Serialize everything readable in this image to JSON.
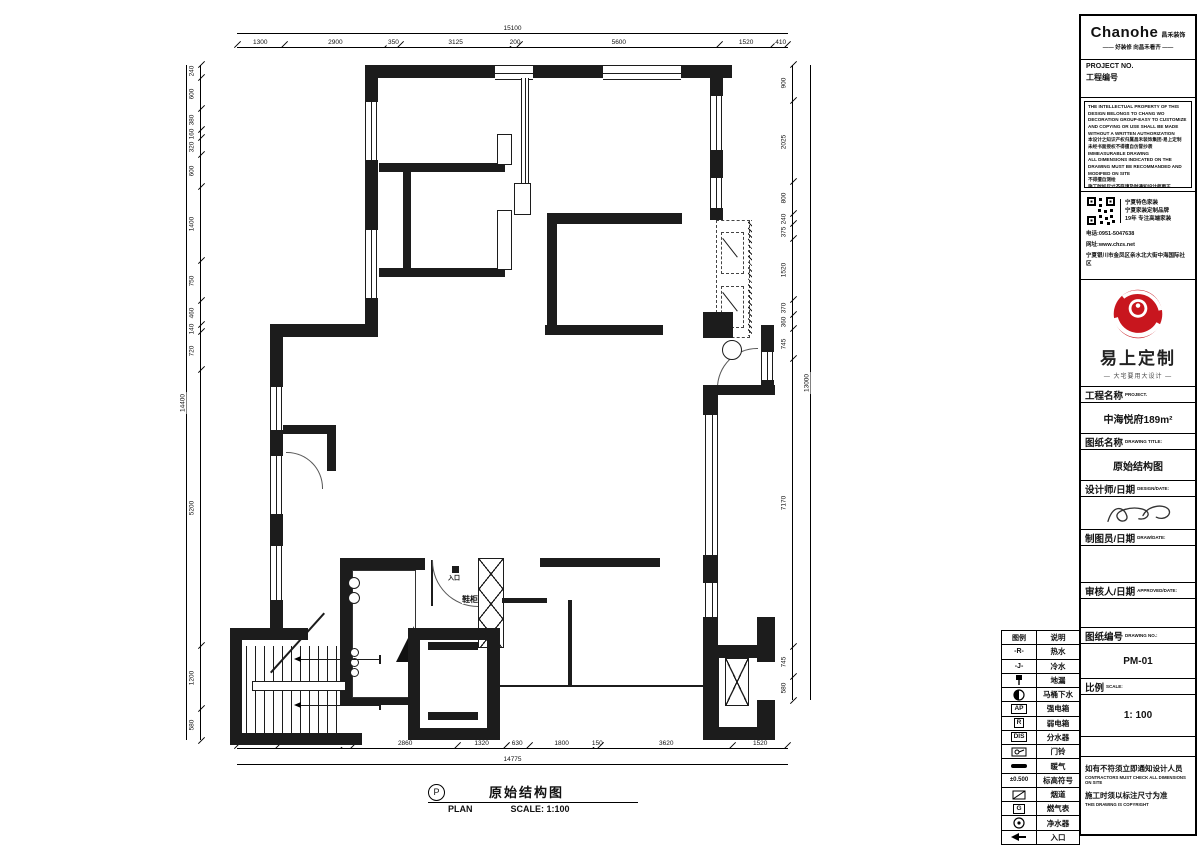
{
  "brand": {
    "logo_text": "Chanohe",
    "logo_cn": "昌禾装饰",
    "tagline": "—— 好装修 向昌禾看齐 ——"
  },
  "project_no": {
    "label_en": "PROJECT  NO.",
    "label_cn": "工程编号"
  },
  "notice_lines": [
    "THE INTELLECTUAL PROPERTY OF THIS",
    "DESIGN BELONGS TO CHANG WO",
    "DECORATION GROUP-EASY TO CUSTOMIZE",
    "AND COPYING OR USE SHALL BE MADE",
    "WITHOUT A WRITTEN AUTHORIZATION",
    "本设计之知识产权归属昌禾装饰集团-易上定制",
    "未经书面授权不得擅自仿冒抄袭",
    "IMMEASURABLE DRAWING",
    "ALL DIMENSIONS INDICATED ON THE",
    "DRAWING MUST BE RECOMMANDED AND",
    "MODIFIED ON SITE",
    "不得擅自测绘",
    "施工时如尺寸不符请及时通知设计师更正"
  ],
  "contact": {
    "qr_lines": [
      "宁夏特色家装",
      "宁夏家装定制品牌",
      "19年 专注高端家装"
    ],
    "phone": "电话:0951-5047638",
    "website": "网址:www.chzs.net",
    "address": "宁夏银川市金凤区亲水北大街中海国际社区"
  },
  "red_brand": {
    "name": "易上定制",
    "tagline": "— 大宅要用大设计 —"
  },
  "fields": {
    "project_name": {
      "label_cn": "工程名称",
      "label_en": "PROJECT.",
      "value": "中海悦府189m²"
    },
    "drawing_title": {
      "label_cn": "图纸名称",
      "label_en": "DRAWING TITLE:",
      "value": "原始结构图"
    },
    "designer": {
      "label_cn": "设计师/日期",
      "label_en": "DESIGN/DATE:"
    },
    "drafter": {
      "label_cn": "制图员/日期",
      "label_en": "DRAW/DATE:"
    },
    "approver": {
      "label_cn": "审核人/日期",
      "label_en": "APPROVED/DATE:"
    },
    "drawing_no": {
      "label_cn": "图纸编号",
      "label_en": "DRAWING NO.:",
      "value": "PM-01"
    },
    "scale": {
      "label_cn": "比例",
      "label_en": "SCALE:",
      "value": "1: 100"
    }
  },
  "footer_notes": {
    "cn1": "如有不符须立即通知设计人员",
    "en1": "CONTRACTORS MUST CHECK ALL DIMENSIONS ON SITE",
    "cn2": "施工时须以标注尺寸为准",
    "en2": "THIS DRAWING IS COPYRIGHT"
  },
  "legend": {
    "headers": [
      "图例",
      "说明"
    ],
    "rows": [
      {
        "symbol": "-R-",
        "label": "热水"
      },
      {
        "symbol": "-J-",
        "label": "冷水"
      },
      {
        "icon": "floor-drain",
        "label": "地漏"
      },
      {
        "icon": "toilet-drain",
        "label": "马桶下水"
      },
      {
        "symbol": "AP",
        "label": "强电箱"
      },
      {
        "symbol": "R",
        "label": "弱电箱"
      },
      {
        "symbol": "DIS",
        "label": "分水器"
      },
      {
        "icon": "doorbell",
        "label": "门铃"
      },
      {
        "icon": "heating-line",
        "label": "暖气"
      },
      {
        "symbol": "±0.500",
        "label": "标高符号"
      },
      {
        "icon": "flue",
        "label": "烟道"
      },
      {
        "symbol": "G",
        "label": "燃气表"
      },
      {
        "icon": "water-purifier",
        "label": "净水器"
      },
      {
        "icon": "entrance-arrow",
        "label": "入口"
      }
    ]
  },
  "plan": {
    "caption_cn": "原始结构图",
    "caption_en": "PLAN",
    "scale_label": "SCALE: 1:100",
    "p_mark": "P",
    "entry_label": "入口",
    "shoe_cabinet_label": "鞋柜"
  },
  "dims": {
    "top": {
      "total": "15100",
      "segments": [
        "1300",
        "2900",
        "350",
        "3125",
        "200",
        "5600",
        "1520",
        "410"
      ]
    },
    "bottom": {
      "total": "14775",
      "segments": [
        "1130",
        "1780",
        "260",
        "2860",
        "1320",
        "630",
        "1800",
        "150",
        "3620",
        "1520"
      ]
    },
    "left": {
      "total": "14400",
      "segments": [
        "240",
        "600",
        "380",
        "160",
        "320",
        "600",
        "1400",
        "750",
        "460",
        "140",
        "720",
        "5200",
        "1200",
        "580"
      ]
    },
    "right": {
      "total": "13000",
      "segments": [
        "900",
        "2025",
        "800",
        "240",
        "375",
        "1520",
        "370",
        "360",
        "745",
        "7170",
        "745",
        "580"
      ]
    }
  }
}
